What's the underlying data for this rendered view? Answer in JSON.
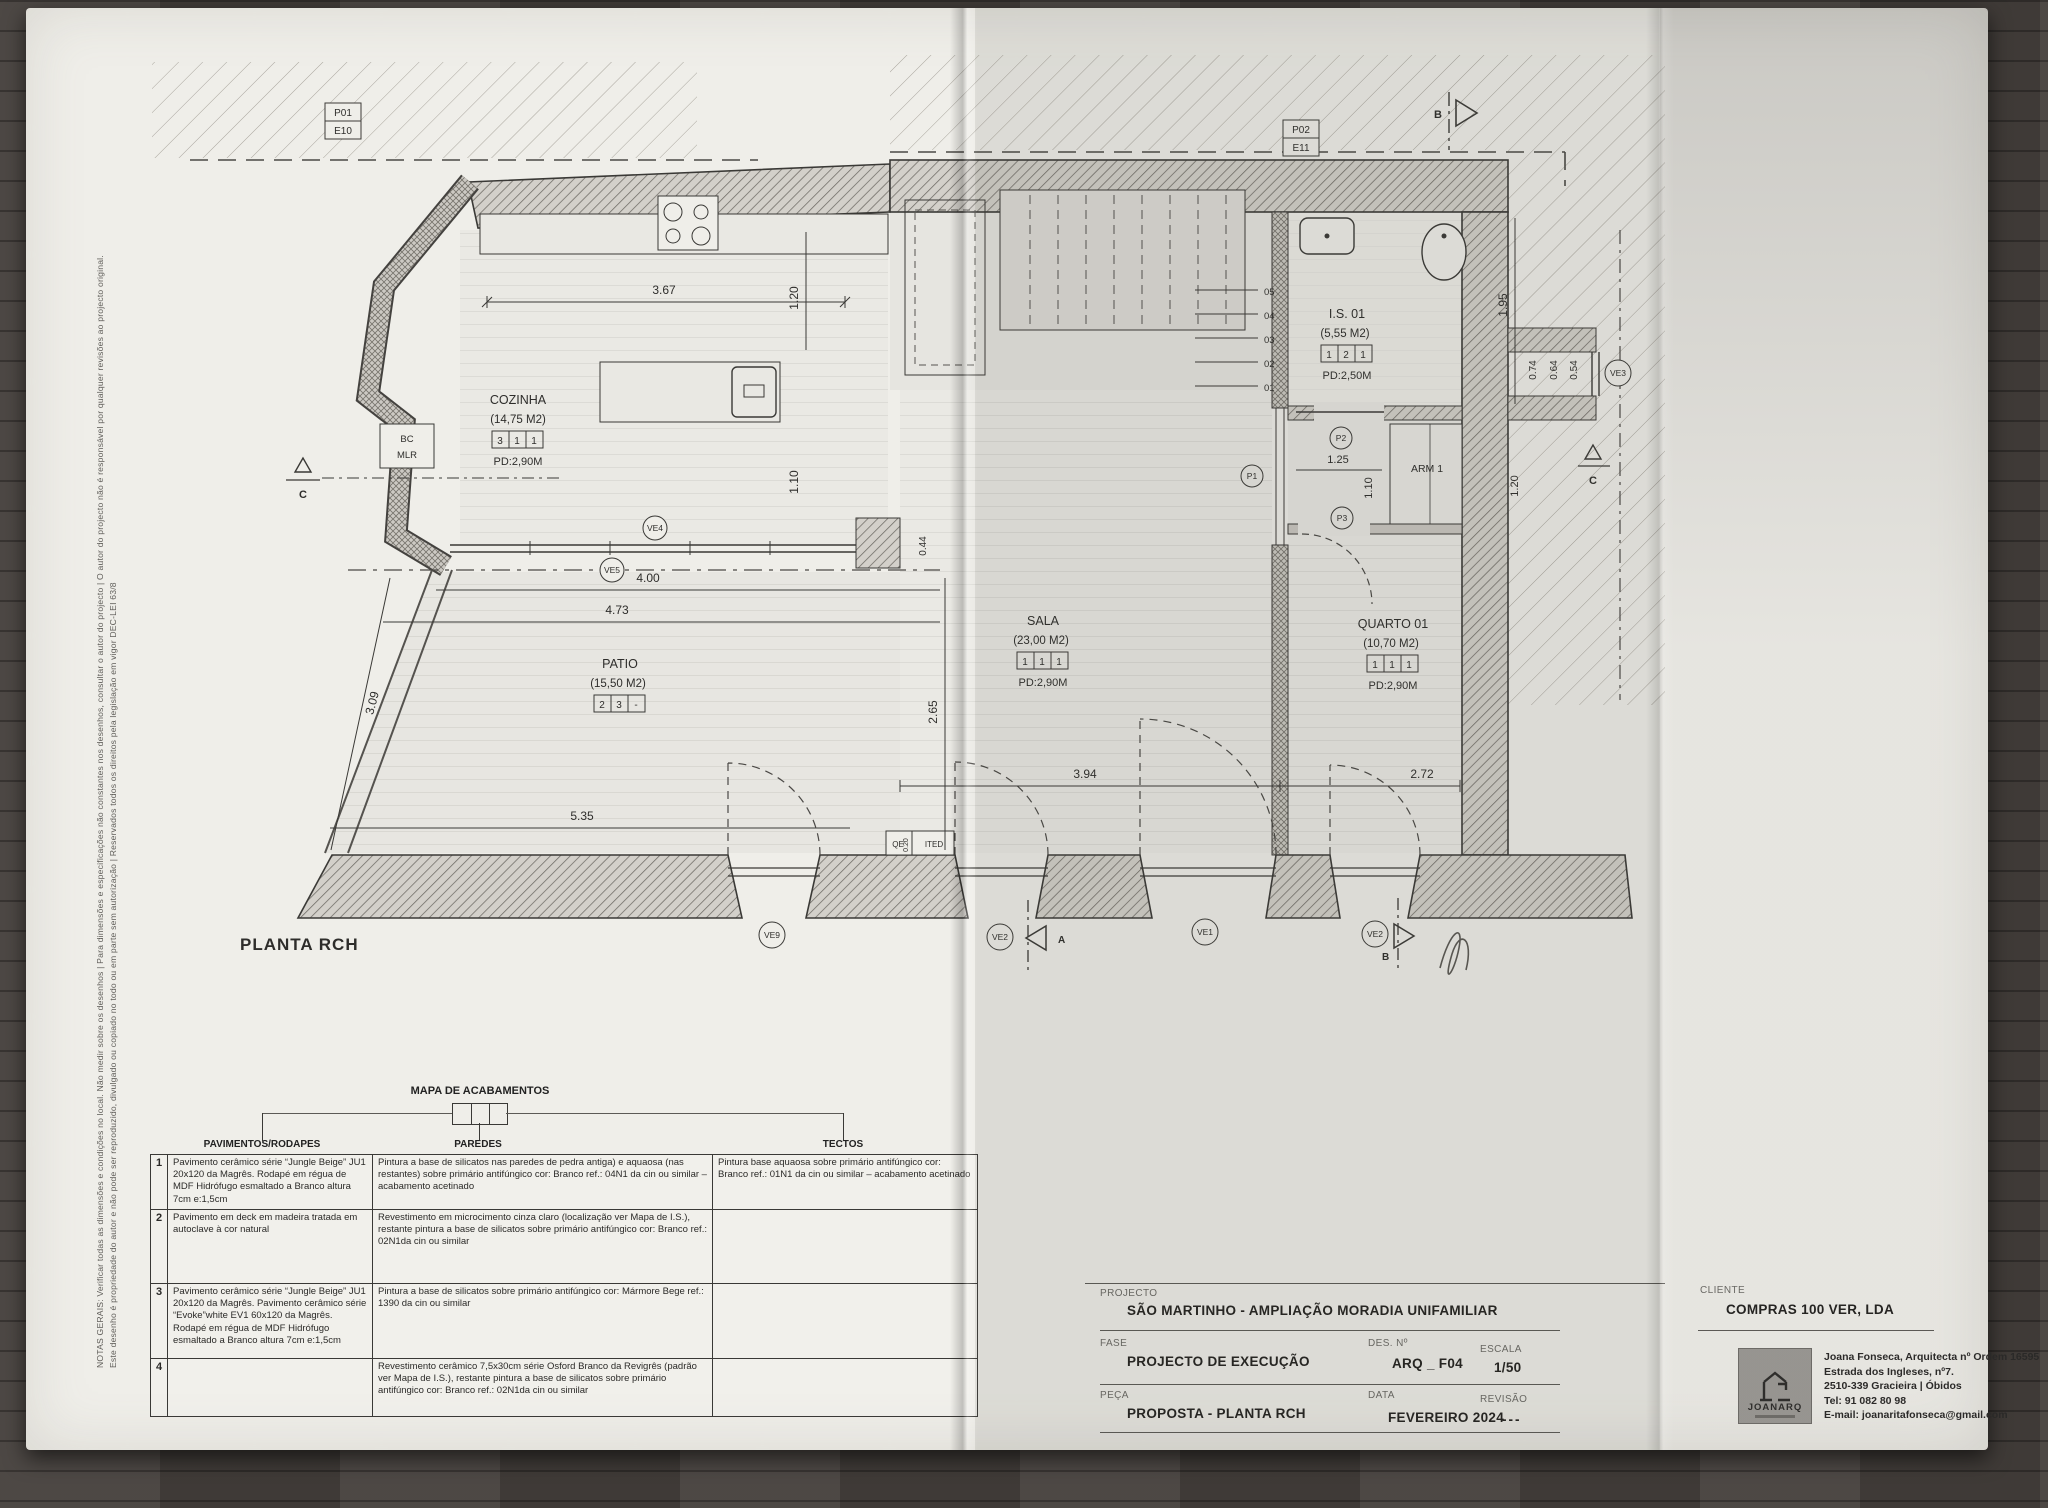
{
  "plan": {
    "title": "PLANTA RCH",
    "rooms": [
      {
        "name": "COZINHA",
        "area": "(14,75 M2)",
        "pd": "PD:2,90M",
        "codes": [
          "3",
          "1",
          "1"
        ]
      },
      {
        "name": "PATIO",
        "area": "(15,50 M2)",
        "pd": "",
        "codes": [
          "2",
          "3",
          "-"
        ]
      },
      {
        "name": "SALA",
        "area": "(23,00 M2)",
        "pd": "PD:2,90M",
        "codes": [
          "1",
          "1",
          "1"
        ]
      },
      {
        "name": "QUARTO 01",
        "area": "(10,70 M2)",
        "pd": "PD:2,90M",
        "codes": [
          "1",
          "1",
          "1"
        ]
      },
      {
        "name": "I.S. 01",
        "area": "(5,55 M2)",
        "pd": "PD:2,50M",
        "codes": [
          "1",
          "2",
          "1"
        ]
      }
    ],
    "labels": {
      "arm": "ARM 1",
      "bc": "BC",
      "mlr": "MLR",
      "qe": "QE",
      "ited": "ITED"
    },
    "refs": [
      {
        "a": "P01",
        "b": "E10"
      },
      {
        "a": "P02",
        "b": "E11"
      }
    ],
    "markers": {
      "ve5": "VE5",
      "ve4": "VE4",
      "ve9": "VE9",
      "ve2a": "VE2",
      "ve1": "VE1",
      "ve2b": "VE2",
      "ve3": "VE3",
      "p1": "P1",
      "p2": "P2",
      "p3": "P3"
    },
    "sections": {
      "a": "A",
      "b": "B",
      "c": "C"
    },
    "steps": [
      "05",
      "04",
      "03",
      "02",
      "01"
    ],
    "dims": {
      "d367": "3.67",
      "d120a": "1.20",
      "d110a": "1.10",
      "d400": "4.00",
      "d473": "4.73",
      "d309": "3.09",
      "d535": "5.35",
      "d044": "0.44",
      "d265": "2.65",
      "d394": "3.94",
      "d272": "2.72",
      "d195": "1.95",
      "d074": "0.74",
      "d064": "0.64",
      "d054": "0.54",
      "d125": "1.25",
      "d110b": "1.10",
      "d120b": "1.20",
      "d020": "0.20"
    }
  },
  "finishes": {
    "title": "MAPA DE ACABAMENTOS",
    "headers": [
      "PAVIMENTOS/RODAPES",
      "PAREDES",
      "TECTOS"
    ],
    "rows": [
      {
        "num": "1",
        "pav": "Pavimento cerâmico série “Jungle Beige” JU1 20x120 da Magrês. Rodapé em régua de MDF Hidrófugo esmaltado a Branco altura 7cm e:1,5cm",
        "par": "Pintura a base de silicatos nas paredes de pedra antiga) e aquaosa (nas restantes) sobre primário antifúngico cor: Branco ref.: 04N1 da cin ou similar – acabamento acetinado",
        "tec": "Pintura base aquaosa sobre primário antifúngico cor: Branco ref.: 01N1 da cin ou similar – acabamento acetinado"
      },
      {
        "num": "2",
        "pav": "Pavimento em deck em madeira tratada em autoclave à cor natural",
        "par": "Revestimento em microcimento cinza claro (localização ver Mapa de I.S.), restante pintura a base de silicatos sobre primário antifúngico cor: Branco ref.: 02N1da cin ou similar",
        "tec": ""
      },
      {
        "num": "3",
        "pav": "Pavimento cerâmico série “Jungle Beige” JU1 20x120 da Magrês. Pavimento cerâmico série “Evoke”white EV1 60x120 da Magrês. Rodapé em régua de MDF Hidrófugo esmaltado a Branco altura 7cm e:1,5cm",
        "par": "Pintura a base de silicatos sobre primário antifúngico cor: Mármore Bege ref.: 1390 da cin ou similar",
        "tec": ""
      },
      {
        "num": "4",
        "pav": "",
        "par": "Revestimento cerâmico 7,5x30cm série Osford Branco da Revigrês (padrão ver Mapa de I.S.), restante pintura a base de silicatos sobre primário antifúngico cor: Branco ref.: 02N1da cin ou similar",
        "tec": ""
      }
    ]
  },
  "title_block": {
    "labels": {
      "projecto": "PROJECTO",
      "fase": "FASE",
      "peca": "PEÇA",
      "des": "DES. Nº",
      "escala": "ESCALA",
      "data": "DATA",
      "revisao": "REVISÃO",
      "cliente": "CLIENTE"
    },
    "values": {
      "projecto": "SÃO MARTINHO  -  AMPLIAÇÃO  MORADIA UNIFAMILIAR",
      "fase": "PROJECTO DE EXECUÇÃO",
      "peca": "PROPOSTA - PLANTA RCH",
      "des": "ARQ _ F04",
      "escala": "1/50",
      "data": "FEVEREIRO 2024",
      "revisao": "---",
      "cliente": "COMPRAS 100 VER, LDA"
    }
  },
  "architect": {
    "firm": "JOANARQ",
    "lines": [
      "Joana Fonseca, Arquitecta nº Ordem 16595",
      "Estrada dos Ingleses, nº7.",
      "2510-339 Gracieira | Óbidos",
      "Tel: 91 082 80 98",
      "E-mail: joanaritafonseca@gmail.com"
    ]
  },
  "notes": {
    "line1": "NOTAS GERAIS: Verificar todas as dimensões e condições no local. Não medir sobre os desenhos | Para dimensões e especificações não constantes nos desenhos, consultar o autor do projecto | O autor do projecto não é responsável por qualquer revisões ao projecto original.",
    "line2": "Este desenho é propriedade do autor e não pode ser reproduzido, divulgado ou copiado no todo ou em parte sem autorização | Reservados todos os direitos pela legislação em vigor DEC-LEI 63/8"
  }
}
